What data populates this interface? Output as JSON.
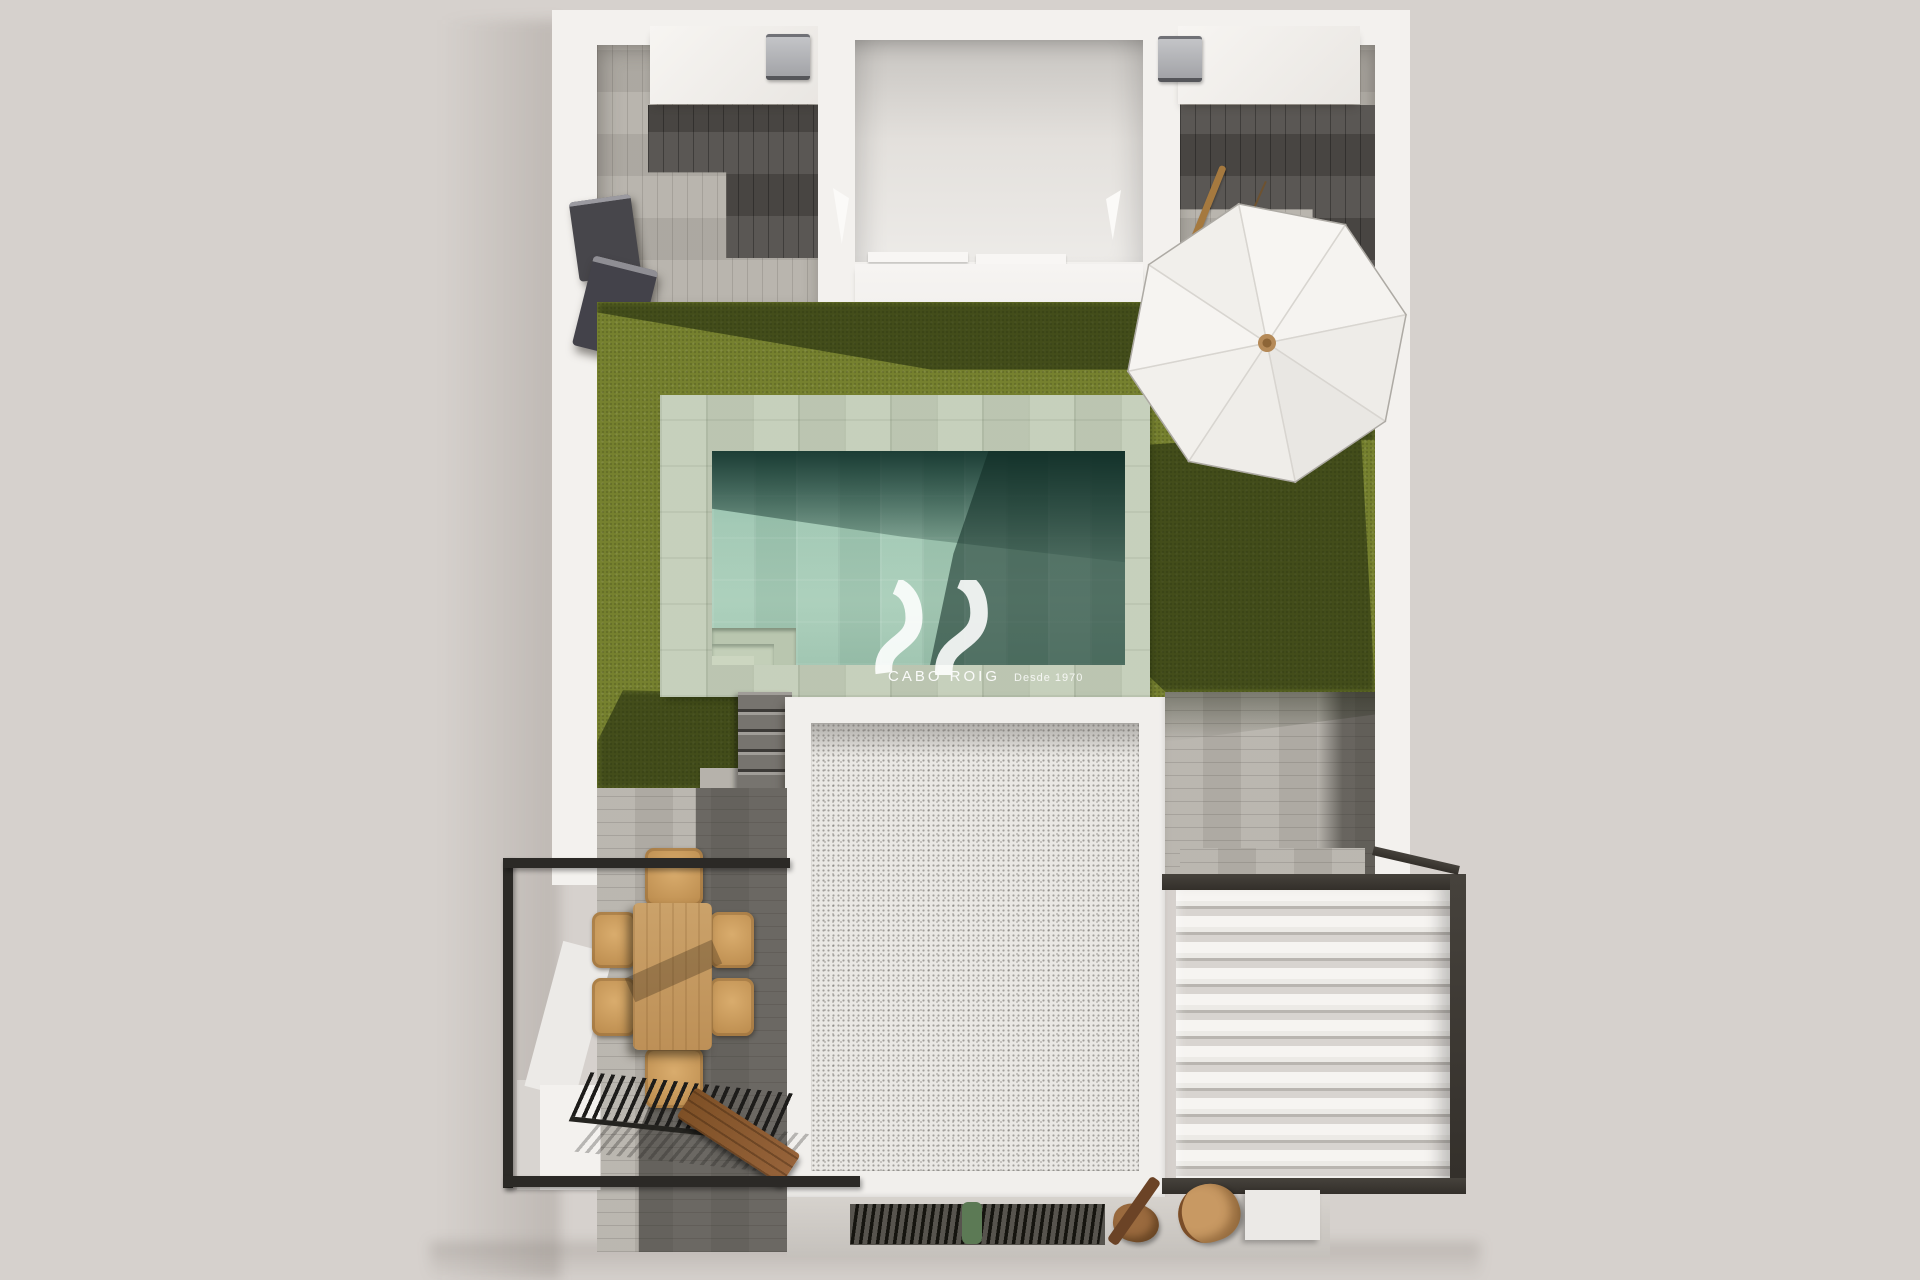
{
  "meta": {
    "description": "Photorealistic top-down 3D architectural render of a detached villa plot with private pool, artificial-grass garden, sun terraces and roof solarium",
    "view": "bird's-eye aerial"
  },
  "watermark": {
    "brand": "CABO ROIG",
    "tagline": "Desde 1970",
    "logo": "double-wave monogram",
    "text_color": "#ffffff"
  },
  "palette": {
    "background": "#d6d1cd",
    "wall_white": "#f3f1ee",
    "grass": "#76812f",
    "grass_shadow": "#36421b",
    "pool_coping": "#c3cdb8",
    "pool_water": "#9cc4b0",
    "pool_water_dark": "#1d463b",
    "deck_wood_light": "#b7b3ac",
    "deck_wood_dark": "#504d49",
    "metal_black": "#2b2926",
    "dining_wood": "#c49a62",
    "roof_gravel": "#eae8e4",
    "louver_white": "#f5f3f0",
    "bench_wood": "#8a5a33",
    "umbrella_white": "#f2f0ed"
  },
  "objects": {
    "pool": "rectangular pool with sage stone coping and corner entry steps",
    "umbrella": "white octagonal parasol with wooden mast",
    "garden": "artificial grass lawn",
    "dining_set": "wooden dining table with six wicker chairs",
    "pergola": "black slatted pergola over lower terrace",
    "louver_roof": "white louvered roof with dark steel frame",
    "ac_units": "two outdoor units on white roof counters",
    "shower_panel": "dark outdoor shower panel on left wall",
    "bench": "diagonal wooden bench",
    "grate": "black floor ventilation grate",
    "building_roof": "white gravel flat roof with parapet",
    "stairs": "grey stone steps from garden to lower terrace"
  }
}
